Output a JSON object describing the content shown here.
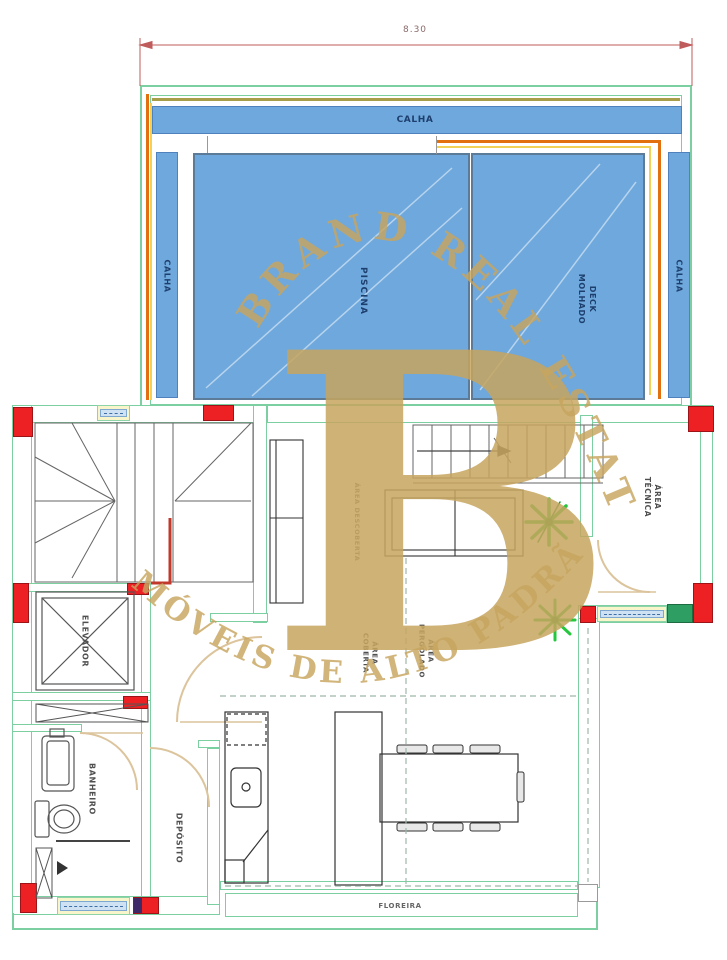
{
  "plan": {
    "dimension_top": "8.30",
    "watermark": {
      "arc_top": "BRAND REAL ESTATE",
      "monogram": "B",
      "arc_bottom": "MÓVEIS DE ALTO PADRÃO"
    },
    "labels": {
      "calha_top": "CALHA",
      "calha_left": "CALHA",
      "calha_right": "CALHA",
      "piscina": "PISCINA",
      "deck_l1": "DECK",
      "deck_l2": "MOLHADO",
      "area_tecnica_l1": "ÁREA",
      "area_tecnica_l2": "TÉCNICA",
      "elevador": "ELEVADOR",
      "banheiro": "BANHEIRO",
      "deposito": "DEPÓSITO",
      "area_descoberta": "ÁREA DESCOBERTA",
      "area_coberta_l1": "ÁREA",
      "area_coberta_l2": "COBERTA",
      "area_pergolado_l1": "ÁREA",
      "area_pergolado_l2": "PERGOLADO",
      "floreira": "FLOREIRA"
    },
    "colors": {
      "wall_green": "#7ccfa0",
      "water_blue": "#6fa8dc",
      "water_border": "#5b7b99",
      "label_navy": "#1d3f6e",
      "column_red": "#ed2024",
      "accent_orange": "#e3700e",
      "accent_yellow": "#f2d157",
      "accent_olive": "#a89e4a",
      "door_beige": "#dcc49c",
      "watermark_gold": "#c7a55f",
      "plant_green": "#24c73d",
      "dimension_red": "#c05b5b"
    }
  }
}
